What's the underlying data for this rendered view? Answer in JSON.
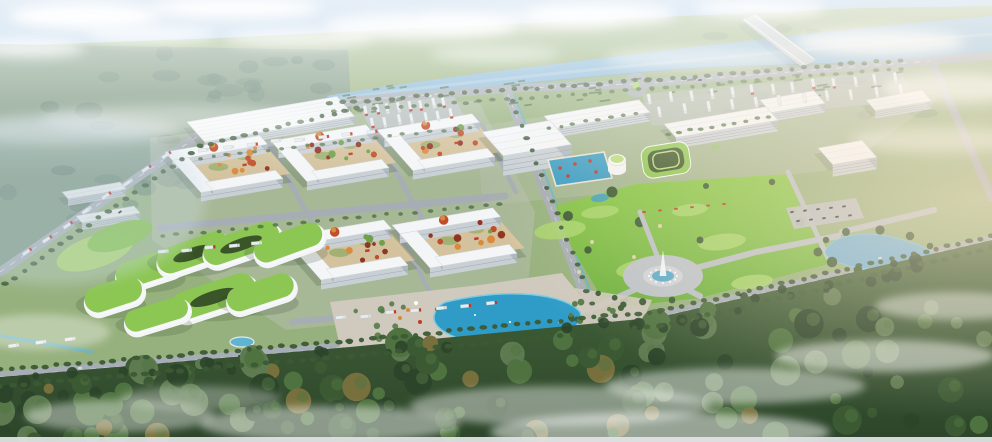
{
  "meta": {
    "description": "Aerial bird's-eye architectural rendering of a riverside business and industrial park masterplan",
    "width": 992,
    "height": 442
  },
  "scene": {
    "regions": [
      "sky-and-clouds",
      "distant-hazy-forest",
      "river",
      "bridge",
      "tree-lined-banks",
      "perimeter-roads",
      "roundabout",
      "logistics-warehouse",
      "courtyard-factory-blocks",
      "truck-parking-lots",
      "office-campus-slabs",
      "rooftop-pool-terrace",
      "green-terraced-buildings",
      "central-golf-park",
      "fountain-plaza",
      "pond",
      "eco-green-roof-complex",
      "lagoon-plaza",
      "forest-belt-with-mist"
    ]
  },
  "palette": {
    "sky_top": "#9cc0e0",
    "sky_mid": "#cfe1f0",
    "sky_low": "#eef4f9",
    "cloud": "#ffffff",
    "mist": "#ffffff",
    "haze": "#f4f8fb",
    "sun": "#ffe9cf",
    "land": "#97b17e",
    "distant_forest": "#7c9884",
    "distant_tree": "#5e7d6c",
    "river": "#88b7d6",
    "river_hi": "#b3d2e4",
    "river_lo": "#6fa3c4",
    "canal": "#5fb4d4",
    "road": "#a6adb4",
    "road_hi": "#b9bfc5",
    "lane": "#e9eef2",
    "pad": "#b7bfad",
    "building": "#f3f5f6",
    "face": "#c9d0d5",
    "side": "#aeb7bd",
    "win": "#8e99a1",
    "shadow": "#2d412d",
    "green_roof": "#8cc653",
    "green_roof_hi": "#b8de7e",
    "green_roof_dark": "#3a5527",
    "court": "#d7c49e",
    "autumn1": "#d98a3c",
    "autumn2": "#bf4e2c",
    "autumn3": "#8f3524",
    "court_green": "#6fa04c",
    "kiosk": "#c23a28",
    "park": "#7fc046",
    "park_hi": "#a8d56c",
    "park_lo": "#66a83a",
    "bunker": "#ddd2a8",
    "pool": "#3f9fc4",
    "lagoon": "#2f9cc8",
    "lagoon_hi": "#7ccbe4",
    "plaza": "#bcc2c8",
    "plaza_tan": "#cfc9be",
    "fountain": "#f2f7fb",
    "pond": "#74b0d2",
    "truck_red": "#c03828",
    "truck_white": "#e8ecef",
    "car_dark": "#2c3237",
    "hedge": "#4e6f44",
    "tree": "#3c5a36",
    "tree_hi": "#557b48",
    "forest_lo": "#2c452a",
    "forest_mid": "#3b5a33",
    "forest_hi": "#4f7340",
    "forest_pale": "#5d7a50",
    "autumn_f": "#77703c",
    "strip": "#dfe2e4"
  }
}
